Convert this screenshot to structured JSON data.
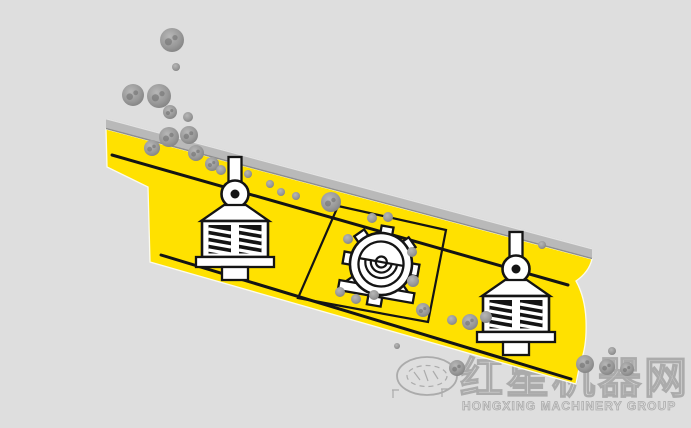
{
  "diagram": {
    "subject": "inclined-vibrating-screen-side-view",
    "components": {
      "deck_strip": "screen-deck-surface",
      "upper_line": "upper-screen-mesh-line",
      "lower_line": "lower-body-line",
      "panel": "middle-section-panel",
      "spring_left": "coil-spring-support-left",
      "spring_right": "coil-spring-support-right",
      "vibrator": "circular-vibration-exciter",
      "rocks": "rock-material-particles"
    }
  },
  "watermark": {
    "cn": "红星机器网",
    "en": "HONGXING MACHINERY GROUP",
    "logo": "oval-brand-logo"
  },
  "colors": {
    "background": "#dedede",
    "body_yellow": "#ffe100",
    "deck_strip": "#b9b9b9",
    "outline_black": "#141414",
    "component_white": "#ffffff",
    "rock_gray": "#9a9a9a",
    "rock_dark": "#6f6f6f",
    "watermark_gray": "#ababab"
  },
  "rocks": {
    "falling_rocks": [
      [
        172,
        40,
        12
      ],
      [
        176,
        67,
        4
      ],
      [
        133,
        95,
        11
      ],
      [
        159,
        96,
        12
      ],
      [
        170,
        112,
        7
      ],
      [
        188,
        117,
        5
      ]
    ],
    "deck_rocks": [
      [
        152,
        148,
        8
      ],
      [
        169,
        137,
        10
      ],
      [
        189,
        135,
        9
      ],
      [
        196,
        153,
        8
      ],
      [
        212,
        164,
        7
      ],
      [
        221,
        170,
        5
      ],
      [
        248,
        174,
        4
      ],
      [
        270,
        184,
        4
      ],
      [
        281,
        192,
        4
      ],
      [
        296,
        196,
        4
      ],
      [
        331,
        202,
        10
      ],
      [
        372,
        218,
        5
      ],
      [
        388,
        217,
        5
      ],
      [
        542,
        245,
        4
      ]
    ],
    "body_particles": [
      [
        348,
        239,
        5
      ],
      [
        412,
        252,
        5
      ],
      [
        413,
        281,
        6
      ],
      [
        374,
        295,
        5
      ],
      [
        340,
        292,
        5
      ],
      [
        356,
        299,
        5
      ],
      [
        423,
        310,
        7
      ],
      [
        452,
        320,
        5
      ],
      [
        470,
        322,
        8
      ],
      [
        486,
        317,
        6
      ],
      [
        397,
        346,
        3
      ]
    ],
    "discharge_rocks": [
      [
        457,
        368,
        8
      ],
      [
        585,
        364,
        9
      ],
      [
        607,
        367,
        8
      ],
      [
        627,
        369,
        7
      ],
      [
        612,
        351,
        4
      ]
    ]
  }
}
